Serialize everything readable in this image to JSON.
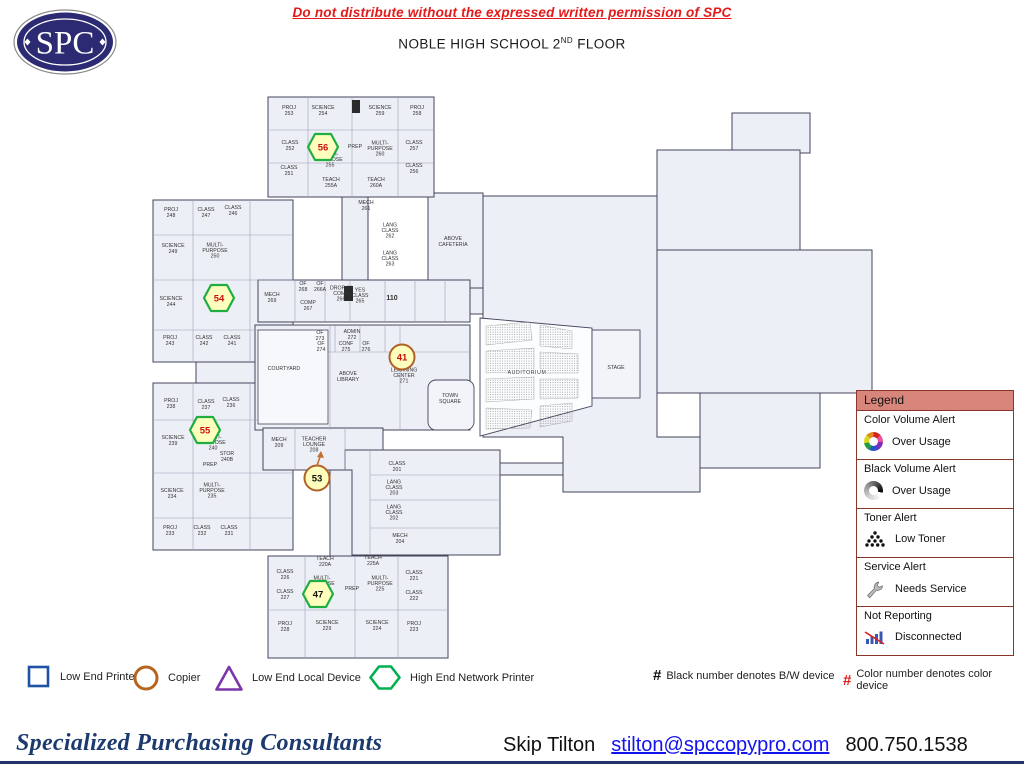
{
  "header": {
    "logo_text": "SPC",
    "warning": "Do not distribute without the expressed written permission of SPC",
    "title_prefix": "NOBLE HIGH SCHOOL 2",
    "title_sup": "ND",
    "title_suffix": " FLOOR"
  },
  "legend": {
    "title": "Legend",
    "sections": [
      {
        "title": "Color Volume Alert",
        "label": "Over Usage",
        "icon": "color-wheel-icon"
      },
      {
        "title": "Black Volume Alert",
        "label": "Over Usage",
        "icon": "black-wheel-icon"
      },
      {
        "title": "Toner Alert",
        "label": "Low Toner",
        "icon": "toner-dots-icon"
      },
      {
        "title": "Service Alert",
        "label": "Needs Service",
        "icon": "wrench-icon"
      },
      {
        "title": "Not Reporting",
        "label": "Disconnected",
        "icon": "bar-chart-slash-icon"
      }
    ]
  },
  "symbol_legend": [
    {
      "shape": "square",
      "color": "#2053a4",
      "label": "Low End Printer"
    },
    {
      "shape": "circle",
      "color": "#b5651d",
      "label": "Copier"
    },
    {
      "shape": "triangle",
      "color": "#7b35a8",
      "label": "Low End Local Device"
    },
    {
      "shape": "hexagon",
      "color": "#00b050",
      "label": "High End Network Printer"
    }
  ],
  "number_notes": [
    {
      "hash_color": "#111111",
      "text": "Black number denotes B/W device"
    },
    {
      "hash_color": "#e41a1a",
      "text": "Color number denotes color device"
    }
  ],
  "footer": {
    "company": "Specialized Purchasing Consultants",
    "contact_name": "Skip Tilton",
    "email": "stilton@spccopypro.com",
    "phone": "800.750.1538"
  },
  "floorplan": {
    "marker_fill": "#ffffbe",
    "hexagon_color": "#1fae3f",
    "circle_color": "#b06226",
    "markers": [
      {
        "n": "56",
        "shape": "hexagon",
        "x": 323,
        "y": 147,
        "number_color": "#cc1111"
      },
      {
        "n": "54",
        "shape": "hexagon",
        "x": 219,
        "y": 298,
        "number_color": "#cc1111"
      },
      {
        "n": "55",
        "shape": "hexagon",
        "x": 205,
        "y": 430,
        "number_color": "#cc1111"
      },
      {
        "n": "47",
        "shape": "hexagon",
        "x": 318,
        "y": 594,
        "number_color": "#111111"
      },
      {
        "n": "41",
        "shape": "circle",
        "x": 402,
        "y": 357,
        "number_color": "#cc1111"
      },
      {
        "n": "53",
        "shape": "circle",
        "x": 317,
        "y": 478,
        "number_color": "#111111",
        "arrow": true
      }
    ],
    "rooms": [
      {
        "t": "PROJ\n253",
        "x": 289,
        "y": 112
      },
      {
        "t": "SCIENCE\n254",
        "x": 323,
        "y": 112
      },
      {
        "t": "SCIENCE\n259",
        "x": 380,
        "y": 112
      },
      {
        "t": "PROJ\n258",
        "x": 417,
        "y": 112
      },
      {
        "t": "CLASS\n252",
        "x": 290,
        "y": 147
      },
      {
        "t": "CLASS\n251",
        "x": 289,
        "y": 172
      },
      {
        "t": "PREP",
        "x": 355,
        "y": 148
      },
      {
        "t": "MULTI-\nPURPOSE\n260",
        "x": 380,
        "y": 150
      },
      {
        "t": "CLASS\n257",
        "x": 414,
        "y": 147
      },
      {
        "t": "CLASS\n256",
        "x": 414,
        "y": 170
      },
      {
        "t": "TEACH\n255A",
        "x": 331,
        "y": 184
      },
      {
        "t": "TEACH\n260A",
        "x": 376,
        "y": 184
      },
      {
        "t": "MULTI-\nPURPOSE\n255",
        "x": 330,
        "y": 161
      },
      {
        "t": "MECH\n261",
        "x": 366,
        "y": 207
      },
      {
        "t": "LANG\nCLASS\n262",
        "x": 390,
        "y": 232
      },
      {
        "t": "LANG\nCLASS\n263",
        "x": 390,
        "y": 260
      },
      {
        "t": "PROJ\n248",
        "x": 171,
        "y": 214
      },
      {
        "t": "CLASS\n247",
        "x": 206,
        "y": 214
      },
      {
        "t": "CLASS\n246",
        "x": 233,
        "y": 212
      },
      {
        "t": "SCIENCE\n249",
        "x": 173,
        "y": 250
      },
      {
        "t": "MULTI-\nPURPOSE\n250",
        "x": 215,
        "y": 252
      },
      {
        "t": "SCIENCE\n244",
        "x": 171,
        "y": 303
      },
      {
        "t": "MULTI-\nPURPOSE\n245",
        "x": 218,
        "y": 296
      },
      {
        "t": "PROJ\n243",
        "x": 170,
        "y": 342
      },
      {
        "t": "CLASS\n242",
        "x": 204,
        "y": 342
      },
      {
        "t": "CLASS\n241",
        "x": 232,
        "y": 342
      },
      {
        "t": "MECH\n269",
        "x": 272,
        "y": 299
      },
      {
        "t": "OF\n268",
        "x": 303,
        "y": 288
      },
      {
        "t": "OF\n266A",
        "x": 320,
        "y": 288
      },
      {
        "t": "DROP-IN\nCOMP\n266",
        "x": 341,
        "y": 295
      },
      {
        "t": "COMP\n267",
        "x": 308,
        "y": 307
      },
      {
        "t": "YES\nCLASS\n265",
        "x": 360,
        "y": 297
      },
      {
        "t": "110",
        "x": 392,
        "y": 300,
        "b": 1
      },
      {
        "t": "OF\n273",
        "x": 320,
        "y": 337
      },
      {
        "t": "ADMIN\n272",
        "x": 352,
        "y": 336
      },
      {
        "t": "OF\n274",
        "x": 321,
        "y": 348
      },
      {
        "t": "CONF\n275",
        "x": 346,
        "y": 348
      },
      {
        "t": "OF\n276",
        "x": 366,
        "y": 348
      },
      {
        "t": "COURTYARD",
        "x": 284,
        "y": 370
      },
      {
        "t": "ABOVE\nLIBRARY",
        "x": 348,
        "y": 378
      },
      {
        "t": "LEARNING\nCENTER\n271",
        "x": 404,
        "y": 377
      },
      {
        "t": "TOWN\nSQUARE",
        "x": 450,
        "y": 400
      },
      {
        "t": "ABOVE\nCAFETERIA",
        "x": 453,
        "y": 243
      },
      {
        "t": "MECH\n209",
        "x": 279,
        "y": 444
      },
      {
        "t": "TEACHER\nLOUNGE\n208",
        "x": 314,
        "y": 446
      },
      {
        "t": "CLASS\n201",
        "x": 397,
        "y": 468
      },
      {
        "t": "LANG\nCLASS\n203",
        "x": 394,
        "y": 489
      },
      {
        "t": "LANG\nCLASS\n202",
        "x": 394,
        "y": 514
      },
      {
        "t": "MECH\n204",
        "x": 400,
        "y": 540
      },
      {
        "t": "TEACH\n220A",
        "x": 325,
        "y": 563
      },
      {
        "t": "TEACH\n225A",
        "x": 373,
        "y": 562
      },
      {
        "t": "CLASS\n226",
        "x": 285,
        "y": 576
      },
      {
        "t": "CLASS\n227",
        "x": 285,
        "y": 596
      },
      {
        "t": "MULTI-\nPURPOSE\n220",
        "x": 322,
        "y": 585
      },
      {
        "t": "PREP",
        "x": 352,
        "y": 590
      },
      {
        "t": "MULTI-\nPURPOSE\n225",
        "x": 380,
        "y": 585
      },
      {
        "t": "CLASS\n221",
        "x": 414,
        "y": 577
      },
      {
        "t": "CLASS\n222",
        "x": 414,
        "y": 597
      },
      {
        "t": "PROJ\n228",
        "x": 285,
        "y": 628
      },
      {
        "t": "SCIENCE\n229",
        "x": 327,
        "y": 627
      },
      {
        "t": "SCIENCE\n224",
        "x": 377,
        "y": 627
      },
      {
        "t": "PROJ\n223",
        "x": 414,
        "y": 628
      },
      {
        "t": "PROJ\n238",
        "x": 171,
        "y": 405
      },
      {
        "t": "CLASS\n237",
        "x": 206,
        "y": 406
      },
      {
        "t": "CLASS\n236",
        "x": 231,
        "y": 404
      },
      {
        "t": "SCIENCE\n239",
        "x": 173,
        "y": 442
      },
      {
        "t": "MULTI-\nPURPOSE\n240",
        "x": 213,
        "y": 444
      },
      {
        "t": "STOR\n240B",
        "x": 227,
        "y": 458
      },
      {
        "t": "PREP",
        "x": 210,
        "y": 466
      },
      {
        "t": "SCIENCE\n234",
        "x": 172,
        "y": 495
      },
      {
        "t": "MULTI-\nPURPOSE\n235",
        "x": 212,
        "y": 492
      },
      {
        "t": "PROJ\n233",
        "x": 170,
        "y": 532
      },
      {
        "t": "CLASS\n232",
        "x": 202,
        "y": 532
      },
      {
        "t": "CLASS\n231",
        "x": 229,
        "y": 532
      },
      {
        "t": "STAGE",
        "x": 616,
        "y": 369
      },
      {
        "t": "AUDITORIUM",
        "x": 527,
        "y": 374,
        "halo": 1
      }
    ]
  }
}
